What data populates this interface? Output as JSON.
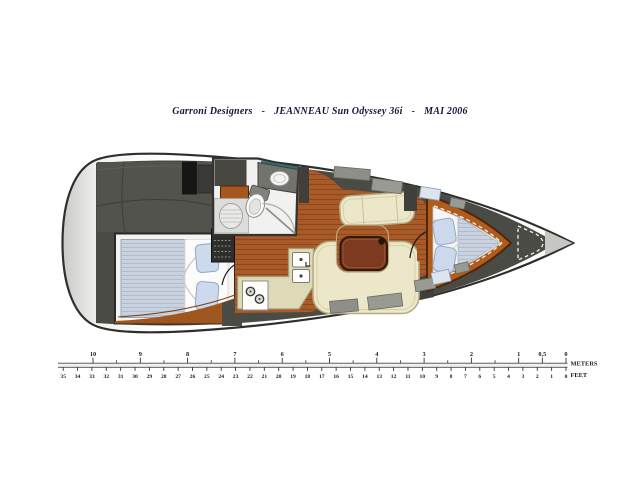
{
  "title": {
    "designer": "Garroni Designers",
    "separator": "-",
    "model": "JEANNEAU Sun Odyssey 36i",
    "date": "MAI 2006"
  },
  "plan": {
    "label": "Jeanneau Sun Odyssey 36i interior layout plan (top view)",
    "regions": [
      "cockpit",
      "aft-double-cabin",
      "head-with-shower",
      "companionway-steps",
      "galley",
      "salon-u-settee",
      "salon-table",
      "port-settee",
      "v-berth-cabin",
      "anchor-locker",
      "bow-tip"
    ]
  },
  "palette": {
    "hull_outline": "#2e2e2c",
    "deck_charcoal": "#4b4b46",
    "wood_floor": "#a85a28",
    "wood_trim": "#b05c1d",
    "table_wood": "#7d3a1e",
    "upholstery_cream": "#ece7c8",
    "counter_cream": "#ded9b6",
    "mattress_blue": "#c9d2df",
    "pillow_blue": "#ccd8ec",
    "title_ink": "#16163a",
    "teal_shelf": "#2f6f72"
  },
  "ruler": {
    "meters": {
      "unit": "METERS",
      "labels": [
        {
          "value": 10,
          "text": "10"
        },
        {
          "value": 9,
          "text": "9"
        },
        {
          "value": 8,
          "text": "8"
        },
        {
          "value": 7,
          "text": "7"
        },
        {
          "value": 6,
          "text": "6"
        },
        {
          "value": 5,
          "text": "5"
        },
        {
          "value": 4,
          "text": "4"
        },
        {
          "value": 3,
          "text": "3"
        },
        {
          "value": 2,
          "text": "2"
        },
        {
          "value": 1,
          "text": "1"
        },
        {
          "value": 0.5,
          "text": "0,5"
        },
        {
          "value": 0,
          "text": "0"
        }
      ]
    },
    "feet": {
      "unit": "FEET",
      "values": [
        35,
        34,
        33,
        32,
        31,
        30,
        29,
        28,
        27,
        26,
        25,
        24,
        23,
        22,
        21,
        20,
        19,
        18,
        17,
        16,
        15,
        14,
        13,
        12,
        11,
        10,
        9,
        8,
        7,
        6,
        5,
        4,
        3,
        2,
        1,
        0
      ]
    }
  }
}
